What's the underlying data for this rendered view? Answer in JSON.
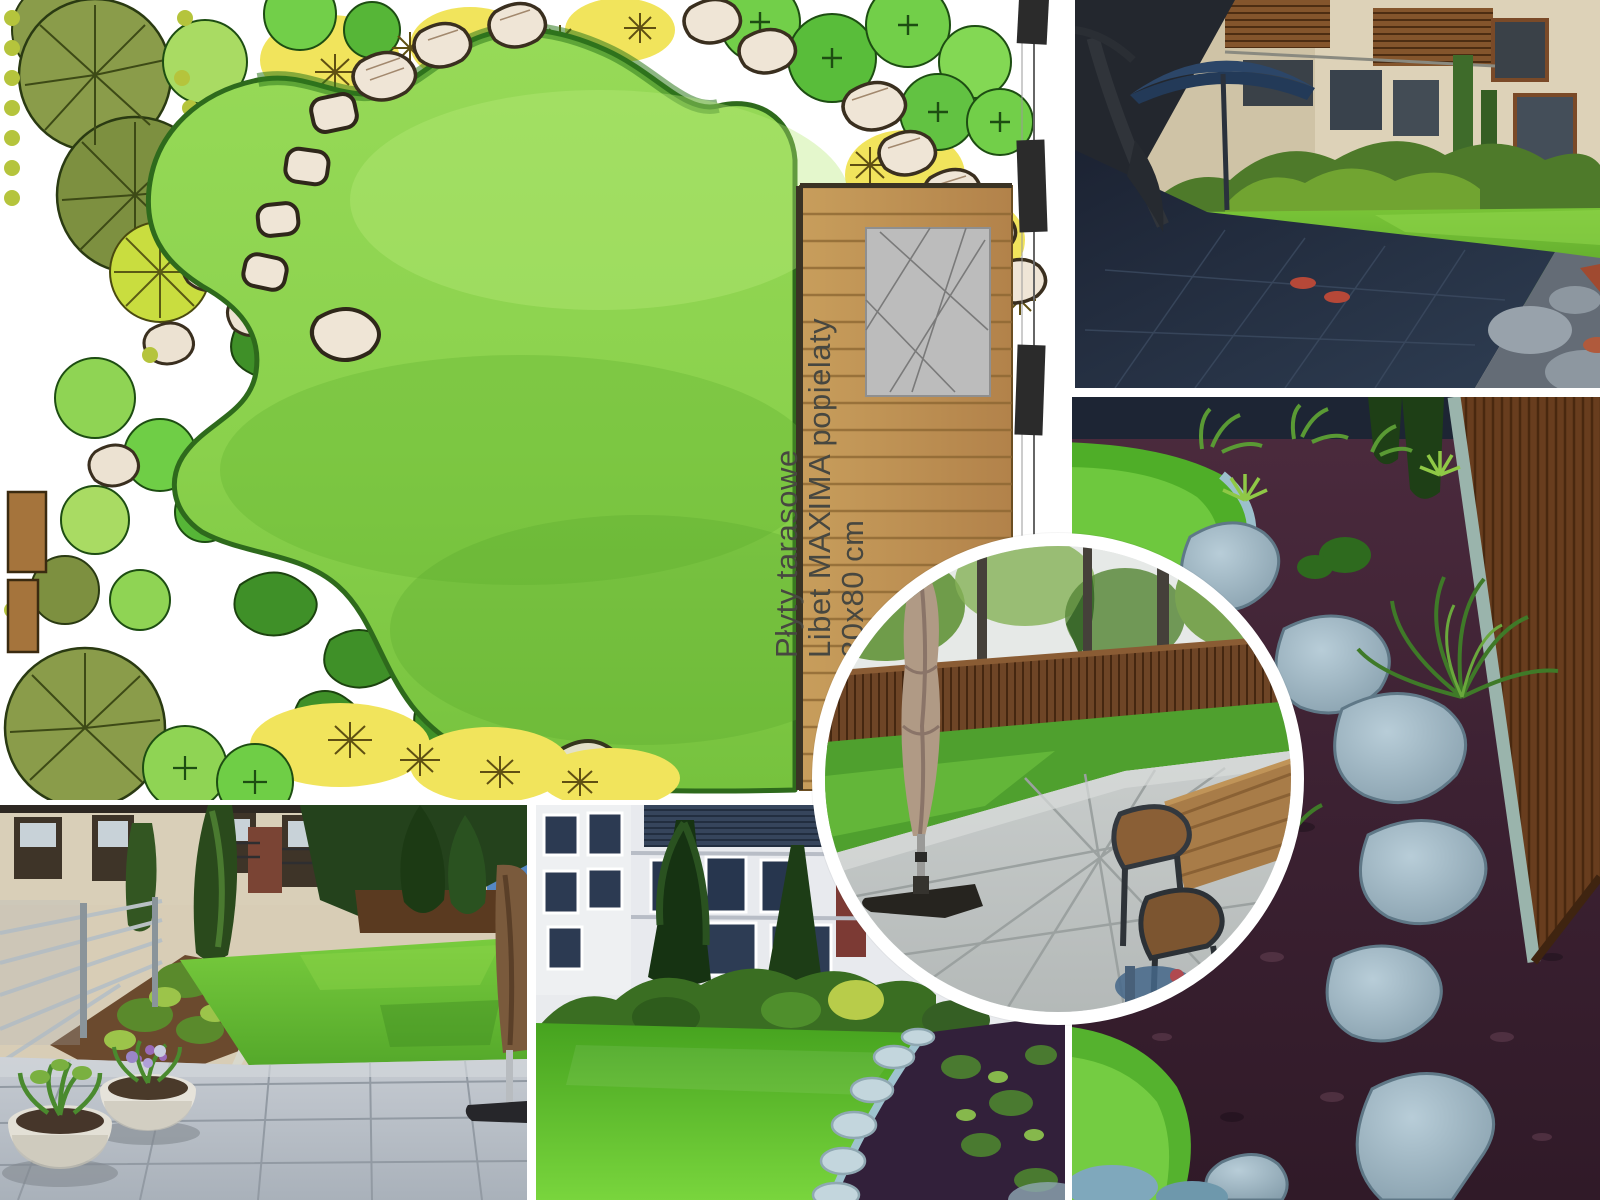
{
  "page": {
    "title": "Garden design before-after collage",
    "background": "#ffffff"
  },
  "plan": {
    "label": {
      "line1": "Płyty tarasowe",
      "line2": "Libet MAXIMA popielaty",
      "line3": "80x80 cm"
    },
    "palette": {
      "lawn": "#8fd450",
      "lawn_shade": "#5fae33",
      "border_green": "#2f7a1e",
      "tree_olive": "#87994a",
      "tree_green": "#6fce46",
      "flower_yellow": "#f1e45c",
      "stone_beige": "#ece2d2",
      "deck_wood": "#c2985a",
      "tile_gray": "#bcbcbc",
      "fence_black": "#2b2b2b"
    }
  },
  "photos": {
    "top_right": {
      "name": "courtyard-garden-hammock-parasol-photo"
    },
    "right": {
      "name": "stepping-stone-path-bark-mulch-photo"
    },
    "bottom_left": {
      "name": "paved-patio-planters-photo"
    },
    "bottom_middle": {
      "name": "apartment-courtyard-lawn-photo"
    },
    "circle_inset": {
      "name": "patio-closed-parasol-table-photo"
    }
  }
}
